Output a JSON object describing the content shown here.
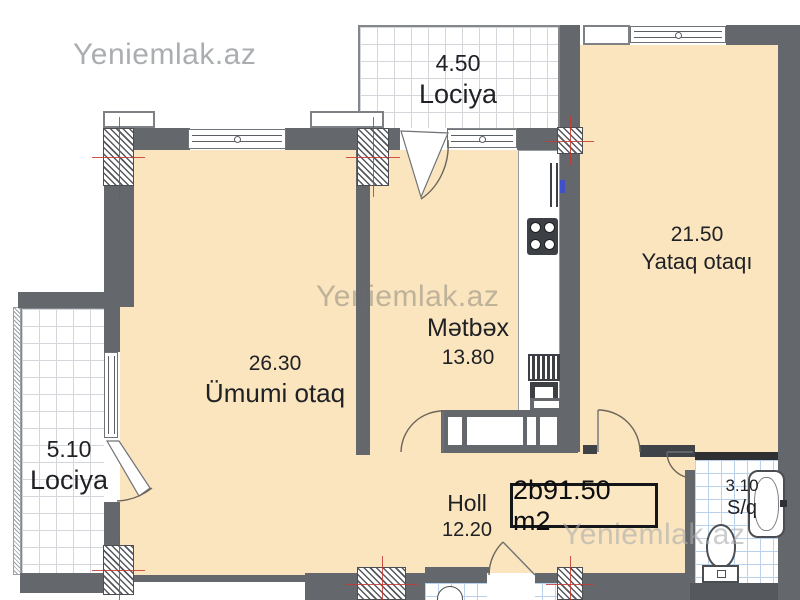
{
  "watermark": {
    "text": "Yeniemlak.az"
  },
  "area_box": {
    "label": "2b91.50 m2"
  },
  "rooms": {
    "balcony_top": {
      "area": "4.50",
      "name": "Lociya"
    },
    "bedroom": {
      "area": "21.50",
      "name": "Yataq otaqı"
    },
    "kitchen": {
      "name": "Mətbəx",
      "area": "13.80"
    },
    "living_room": {
      "area": "26.30",
      "name": "Ümumi otaq"
    },
    "balcony_left": {
      "area": "5.10",
      "name": "Lociya"
    },
    "hall": {
      "name": "Holl",
      "area": "12.20"
    },
    "bathroom": {
      "area": "3.10",
      "name": "S/q"
    }
  },
  "colors": {
    "floor": "#fae5be",
    "wall": "#64686d",
    "tile_line": "#d3d6da",
    "bath_tile_line": "#bad1eb",
    "crosshair_red": "#c53730",
    "blue_mark": "#4050c8"
  }
}
